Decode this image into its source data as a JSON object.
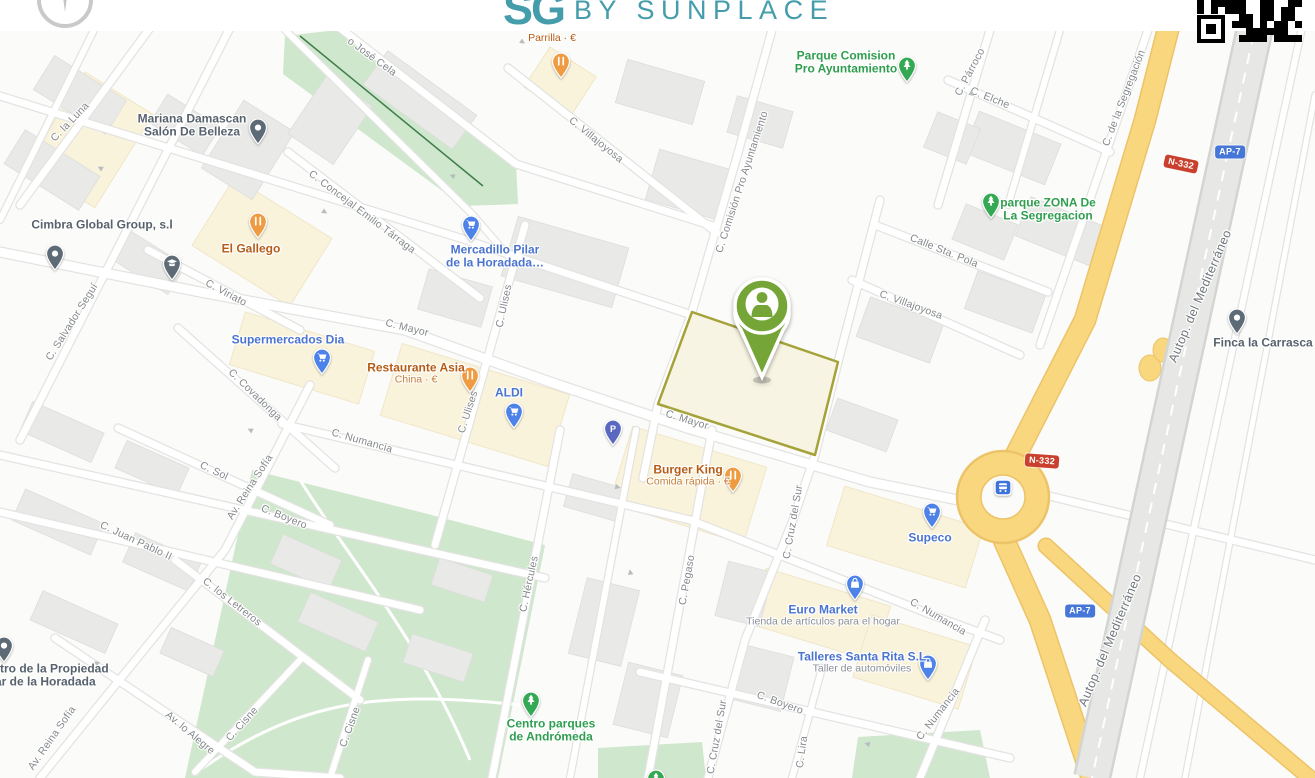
{
  "colors": {
    "brand_teal": "#459dac",
    "pin_green": "#74a536",
    "parcel_border": "#a6a23a",
    "road_yellow": "#f8d77e",
    "badge_red": "#c9412e",
    "badge_blue": "#4676d7",
    "park_fill": "#cfe7cc",
    "food_label": "#b65c17",
    "food_sub": "#c5803c",
    "shop_label": "#4a74cf",
    "shop_sub": "#8a9099",
    "park_label": "#2f9e4f",
    "generic_label": "#57626d",
    "street_label": "#84888c"
  },
  "pin_colors": {
    "food": "#ee9b41",
    "shop": "#4d82e8",
    "park": "#34a853",
    "generic": "#5d6b77",
    "parking": "#5a68c0",
    "bus": "#3d74d9"
  },
  "header": {
    "logo_mark": "SG",
    "brand_text": "BY SUNPLACE"
  },
  "map": {
    "street_labels": [
      {
        "t": "o José Cela",
        "x": 372,
        "y": 57,
        "r": 36
      },
      {
        "t": "C. la Luna",
        "x": 70,
        "y": 122,
        "r": -46
      },
      {
        "t": "C. Concejal Emilio Tárraga",
        "x": 362,
        "y": 212,
        "r": 37
      },
      {
        "t": "C. Salvador Seguí",
        "x": 72,
        "y": 322,
        "r": -58
      },
      {
        "t": "C. Viriato",
        "x": 226,
        "y": 293,
        "r": 28
      },
      {
        "t": "C. Covadonga",
        "x": 255,
        "y": 395,
        "r": 44
      },
      {
        "t": "C. Mayor",
        "x": 407,
        "y": 328,
        "r": 14
      },
      {
        "t": "C. Mayor",
        "x": 687,
        "y": 420,
        "r": 17
      },
      {
        "t": "C. Ulises",
        "x": 504,
        "y": 306,
        "r": -78
      },
      {
        "t": "C. Ulises",
        "x": 468,
        "y": 412,
        "r": -72
      },
      {
        "t": "C. Villajoyosa",
        "x": 596,
        "y": 140,
        "r": 39
      },
      {
        "t": "C. Villajoyosa",
        "x": 911,
        "y": 305,
        "r": 20
      },
      {
        "t": "C. Comisión Pro Ayuntamiento",
        "x": 742,
        "y": 182,
        "r": -72
      },
      {
        "t": "C. Párroco",
        "x": 970,
        "y": 72,
        "r": -62
      },
      {
        "t": "C. Elche",
        "x": 990,
        "y": 98,
        "r": 22
      },
      {
        "t": "Calle Sta. Pola",
        "x": 944,
        "y": 251,
        "r": 22
      },
      {
        "t": "C. de la Segregación",
        "x": 1124,
        "y": 98,
        "r": -69
      },
      {
        "t": "C. Numancia",
        "x": 362,
        "y": 441,
        "r": 16
      },
      {
        "t": "C. Numancia",
        "x": 938,
        "y": 617,
        "r": 30
      },
      {
        "t": "C. Numancia",
        "x": 938,
        "y": 714,
        "r": -52
      },
      {
        "t": "C. Cruz del Sur",
        "x": 793,
        "y": 522,
        "r": -80
      },
      {
        "t": "C. Cruz del Sur",
        "x": 717,
        "y": 737,
        "r": -80
      },
      {
        "t": "C. Sol",
        "x": 214,
        "y": 471,
        "r": 25
      },
      {
        "t": "Av. Reina Sofía",
        "x": 250,
        "y": 487,
        "r": -57
      },
      {
        "t": "Av. Reina Sofía",
        "x": 52,
        "y": 738,
        "r": -55
      },
      {
        "t": "C. Juan Pablo II",
        "x": 136,
        "y": 541,
        "r": 25
      },
      {
        "t": "C. los Letreros",
        "x": 232,
        "y": 602,
        "r": 38
      },
      {
        "t": "Av. lo Alegre",
        "x": 190,
        "y": 733,
        "r": 40
      },
      {
        "t": "C. Cisne",
        "x": 242,
        "y": 724,
        "r": -48
      },
      {
        "t": "C. Cisne",
        "x": 350,
        "y": 727,
        "r": -70
      },
      {
        "t": "C. Hércules",
        "x": 529,
        "y": 584,
        "r": -78
      },
      {
        "t": "C. Pegaso",
        "x": 687,
        "y": 580,
        "r": -80
      },
      {
        "t": "C. Boyero",
        "x": 284,
        "y": 517,
        "r": 22
      },
      {
        "t": "C. Boyero",
        "x": 780,
        "y": 703,
        "r": 20
      },
      {
        "t": "C. Lira",
        "x": 802,
        "y": 752,
        "r": -82
      },
      {
        "t": "Autop. del Mediterráneo",
        "x": 1200,
        "y": 296,
        "r": -67,
        "c": "hwy"
      },
      {
        "t": "Autop. del Mediterráneo",
        "x": 1110,
        "y": 640,
        "r": -67,
        "c": "hwy"
      }
    ],
    "road_badges": [
      {
        "t": "N-332",
        "cls": "red",
        "x": 1181,
        "y": 164,
        "r": 12
      },
      {
        "t": "AP-7",
        "cls": "blue",
        "x": 1230,
        "y": 152,
        "r": 0
      },
      {
        "t": "N-332",
        "cls": "red",
        "x": 1042,
        "y": 461,
        "r": 4
      },
      {
        "t": "AP-7",
        "cls": "blue",
        "x": 1080,
        "y": 611,
        "r": 0
      }
    ],
    "oneway_arrows": [
      {
        "x": 100,
        "y": 168,
        "r": 210
      },
      {
        "x": 325,
        "y": 212,
        "r": 32
      },
      {
        "x": 452,
        "y": 176,
        "r": 200
      },
      {
        "x": 523,
        "y": 42,
        "r": 32
      },
      {
        "x": 250,
        "y": 430,
        "r": 205
      },
      {
        "x": 618,
        "y": 487,
        "r": 15
      },
      {
        "x": 867,
        "y": 744,
        "r": 195
      },
      {
        "x": 96,
        "y": 663,
        "r": 212
      },
      {
        "x": 630,
        "y": 572,
        "r": 260
      },
      {
        "x": 972,
        "y": 94,
        "r": 35
      }
    ],
    "pois": [
      {
        "name": "Parrilla · €",
        "cls": "food mini",
        "icon": "restaurant",
        "lx": 552,
        "ly": 39,
        "px": 561,
        "py": 78
      },
      {
        "name": "Parque Comision",
        "name2": "Pro Ayuntamiento",
        "cls": "park",
        "icon": "tree",
        "lx": 846,
        "ly": 63,
        "px": 907,
        "py": 82
      },
      {
        "name": "Mariana Damascan",
        "name2": "Salón De Belleza",
        "cls": "generic",
        "icon": "dot",
        "lx": 192,
        "ly": 126,
        "px": 258,
        "py": 144
      },
      {
        "name": "Cimbra Global Group, s.l",
        "cls": "generic",
        "icon": "dot",
        "lx": 102,
        "ly": 225,
        "px": 55,
        "py": 270
      },
      {
        "name": "El Gallego",
        "cls": "food",
        "icon": "restaurant",
        "lx": 251,
        "ly": 249,
        "px": 258,
        "py": 238
      },
      {
        "name": "Mercadillo Pilar",
        "name2": "de la Horadada…",
        "cls": "shop",
        "icon": "cart",
        "lx": 495,
        "ly": 257,
        "px": 471,
        "py": 241
      },
      {
        "name": "Supermercados Dia",
        "cls": "shop",
        "icon": "cart",
        "lx": 288,
        "ly": 340,
        "px": 322,
        "py": 374
      },
      {
        "name": "Restaurante Asia",
        "sub": "China · €",
        "cls": "food",
        "icon": "restaurant",
        "lx": 416,
        "ly": 374,
        "px": 470,
        "py": 392
      },
      {
        "name": "ALDI",
        "cls": "shop",
        "icon": "cart",
        "lx": 509,
        "ly": 393,
        "px": 514,
        "py": 428
      },
      {
        "name": "Burger King",
        "sub": "Comida rápida · €",
        "cls": "food",
        "icon": "restaurant",
        "lx": 688,
        "ly": 476,
        "px": 733,
        "py": 492
      },
      {
        "name": "Supeco",
        "cls": "shop",
        "icon": "cart",
        "lx": 930,
        "ly": 538,
        "px": 932,
        "py": 528
      },
      {
        "name": "Euro Market",
        "sub": "Tienda de artículos para el hogar",
        "cls": "shop",
        "icon": "bag",
        "lx": 823,
        "ly": 616,
        "px": 855,
        "py": 600
      },
      {
        "name": "Talleres Santa Rita S.L",
        "sub": "Taller de automóviles",
        "cls": "shop",
        "icon": "bag",
        "lx": 862,
        "ly": 663,
        "px": 928,
        "py": 680
      },
      {
        "name": "parque ZONA De",
        "name2": "La Segregacion",
        "cls": "park",
        "icon": "tree",
        "lx": 1048,
        "ly": 210,
        "px": 991,
        "py": 218
      },
      {
        "name": "Finca la Carrasca",
        "cls": "generic",
        "icon": "dot",
        "lx": 1263,
        "ly": 343,
        "px": 1237,
        "py": 334
      },
      {
        "name": "Registro de la Propiedad",
        "name2": "Pilar de la Horadada",
        "cls": "generic",
        "icon": "dot",
        "lx": 38,
        "ly": 676,
        "px": 4,
        "py": 662
      },
      {
        "name": "Centro parques",
        "name2": "de Andrómeda",
        "cls": "park",
        "icon": "tree",
        "lx": 551,
        "ly": 731,
        "px": 531,
        "py": 717
      },
      {
        "cls": "generic",
        "icon": "school",
        "px": 172,
        "py": 280
      },
      {
        "cls": "parking",
        "icon": "parking",
        "px": 613,
        "py": 445
      },
      {
        "cls": "bus",
        "icon": "bus",
        "px": 1003,
        "py": 487
      },
      {
        "cls": "park",
        "icon": "tree",
        "px": 656,
        "py": 795
      }
    ]
  }
}
